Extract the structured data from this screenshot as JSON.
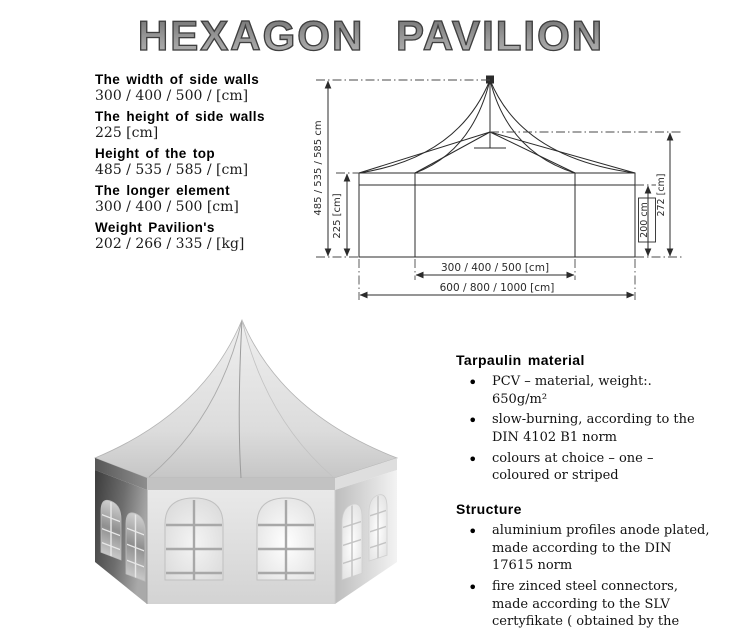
{
  "title": "HEXAGON PAVILION",
  "specs": {
    "items": [
      {
        "label": "The width of side walls",
        "value": "300 / 400 / 500 / [cm]"
      },
      {
        "label": "The height of side walls",
        "value": "225 [cm]"
      },
      {
        "label": "Height of the top",
        "value": "485 / 535 / 585 / [cm]"
      },
      {
        "label": "The longer element",
        "value": "300 / 400 / 500 [cm]"
      },
      {
        "label": "Weight Pavilion's",
        "value": "202 / 266 / 335 / [kg]"
      }
    ]
  },
  "diagram": {
    "labels": {
      "total_height": "485 / 535 / 585 cm",
      "wall_height": "225 [cm]",
      "side_200": "200 cm",
      "side_272": "272 [cm]",
      "inner_width": "300 / 400 / 500 [cm]",
      "outer_width": "600 / 800 / 1000 [cm]"
    }
  },
  "sections": [
    {
      "heading": "Tarpaulin material",
      "bullets": [
        "PCV – material, weight:. 650g/m²",
        "slow-burning, according to the DIN 4102 B1 norm",
        "colours at choice – one – coloured or striped"
      ]
    },
    {
      "heading": "Structure",
      "bullets": [
        "aluminium profiles anode plated, made according to the DIN 17615 norm",
        "fire zinced steel connectors, made according to the SLV certyfikate ( obtained by the firm ) and the DIN 18800 norm"
      ]
    }
  ],
  "colors": {
    "title_fill": "#8f8f8f",
    "title_outline": "#3f3f3f",
    "drawing_line": "#2b2b2b",
    "ink": "#000000"
  }
}
